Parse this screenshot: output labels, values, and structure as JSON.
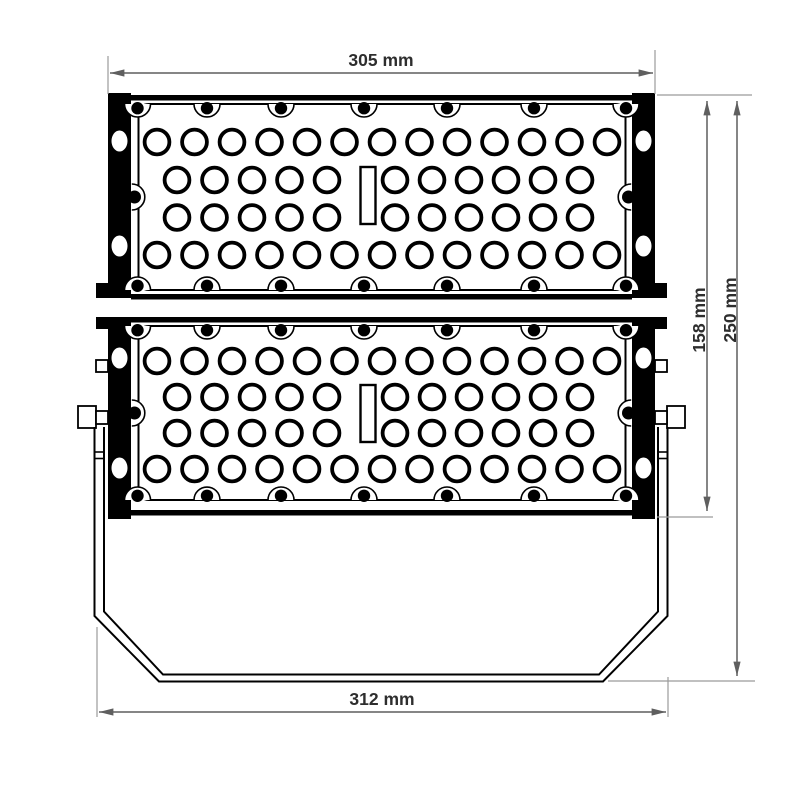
{
  "drawing": {
    "type": "technical-drawing",
    "subject": "LED floodlight front view with two perforated heat-sink modules and mounting yoke",
    "dimensions": [
      {
        "id": "width_top",
        "label": "305 mm",
        "orientation": "horizontal",
        "measures": "body width across side rails"
      },
      {
        "id": "height_body",
        "label": "158 mm",
        "orientation": "vertical",
        "measures": "height of lamp body"
      },
      {
        "id": "height_total",
        "label": "250 mm",
        "orientation": "vertical",
        "measures": "total height including yoke"
      },
      {
        "id": "width_bracket",
        "label": "312 mm",
        "orientation": "horizontal",
        "measures": "width across mounting yoke"
      }
    ],
    "colors": {
      "ink": "#000000",
      "dimension_line": "#5f5f5f",
      "extension_line": "#9b9b9b",
      "label_text": "#2e2e2e",
      "background": "#ffffff"
    },
    "modules": {
      "count": 2,
      "full_row_holes": 13,
      "split_row_holes_left": 5,
      "split_row_holes_right": 6,
      "screw_dots_per_edge": 7,
      "center_slots_per_module": 1,
      "rail_slots_per_side": 2
    }
  }
}
